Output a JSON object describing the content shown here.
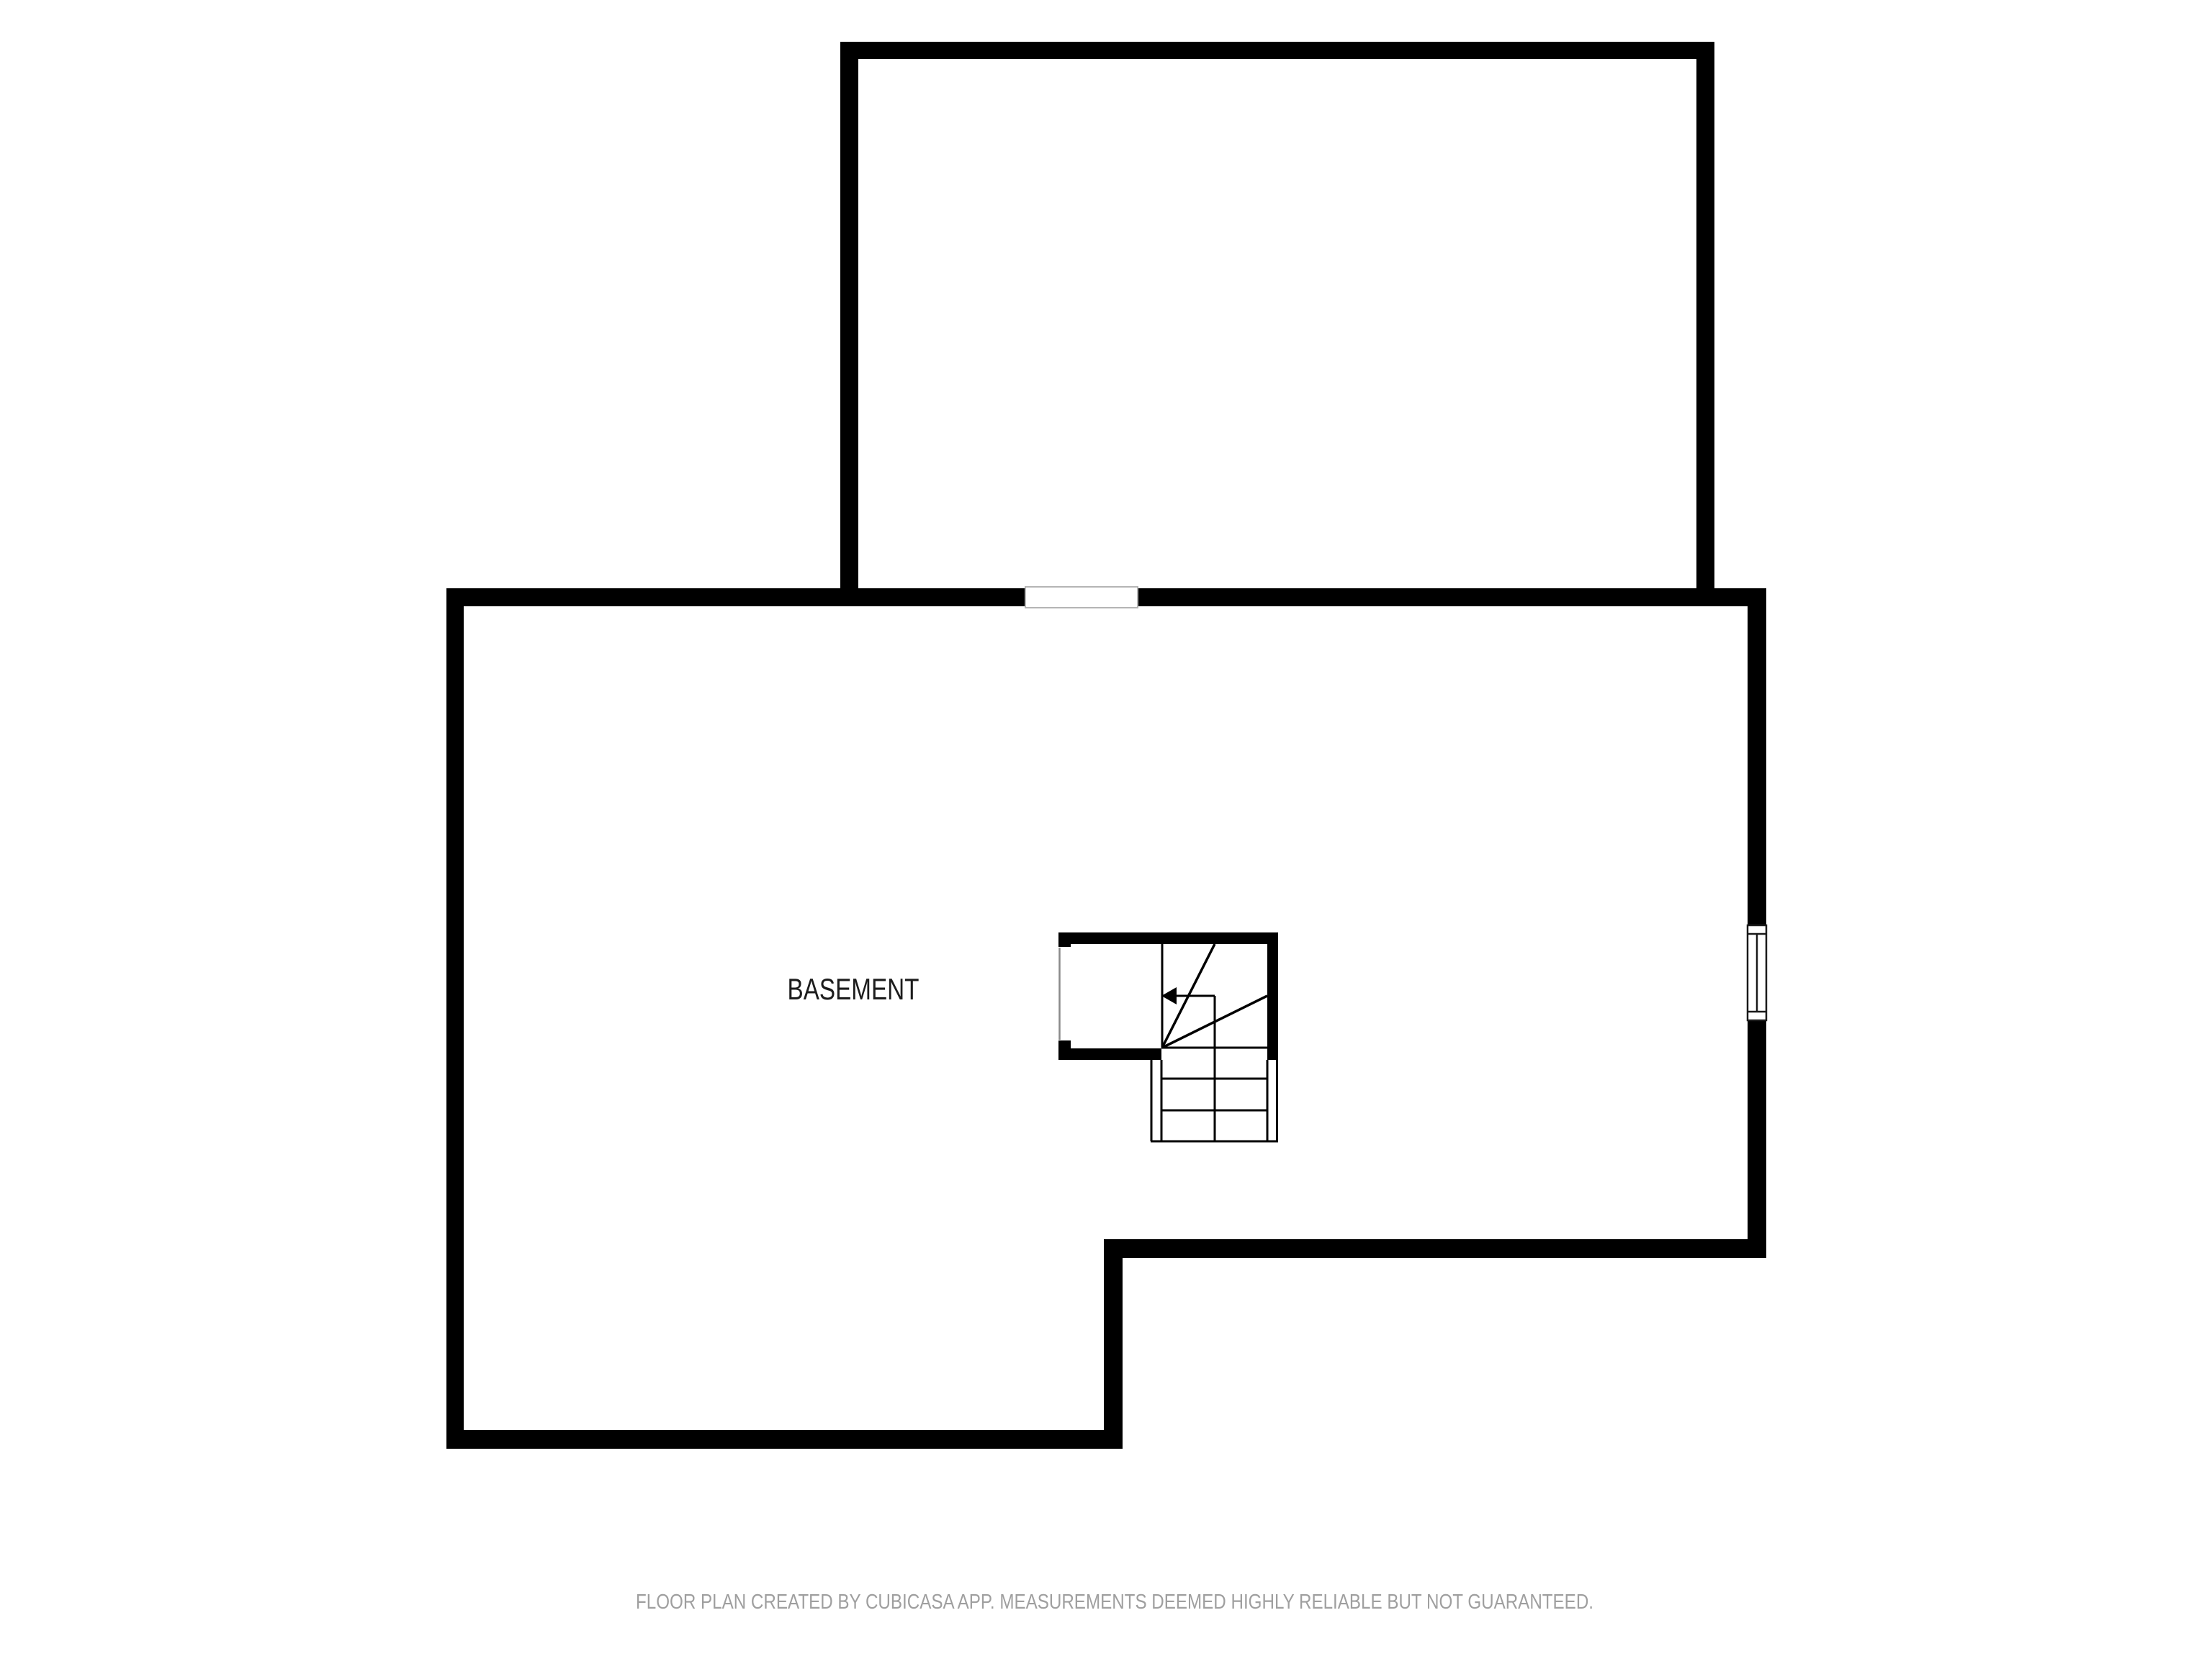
{
  "document": {
    "kind": "floor-plan",
    "background_color": "#ffffff",
    "wall_color": "#000000",
    "interior_wall_color": "#000000",
    "opening_outline_color": "#b5b5b5",
    "window_outline_color": "#1a1a1a"
  },
  "rooms": [
    {
      "label": "BASEMENT",
      "label_color": "#1c1c1c"
    }
  ],
  "stairs": {
    "type": "winder-with-straight-run",
    "direction_arrow": "left"
  },
  "footer": {
    "disclaimer": "FLOOR PLAN CREATED BY CUBICASA APP. MEASUREMENTS DEEMED HIGHLY RELIABLE BUT NOT GUARANTEED.",
    "text_color": "#9f9f9f"
  }
}
